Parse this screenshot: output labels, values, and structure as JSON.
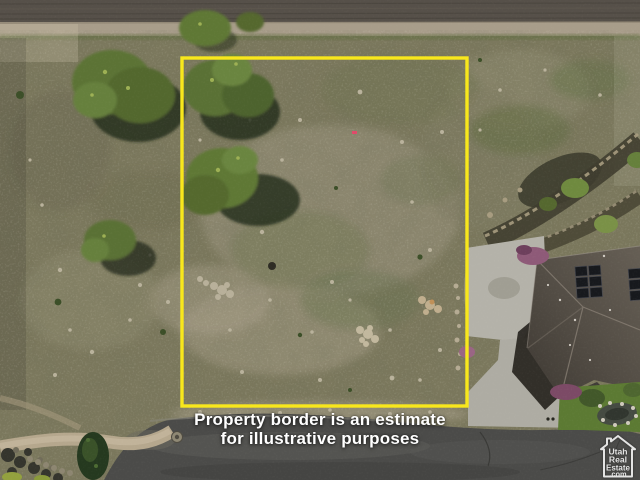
{
  "scene": {
    "name": "aerial-lot-photo",
    "colors": {
      "border_yellow": "#f8e71c",
      "scrub_ground": "#7b785d",
      "stony_patch": "#a39c87",
      "tree_canopy": "#5e7637",
      "dirt_field": "#565049",
      "gravel_road": "#a89d8a",
      "asphalt_road": "#4b4b49",
      "concrete": "#b4b2a9",
      "house_roof": "#56504a",
      "solar_panel": "#17191d",
      "lawn": "#5c7a33"
    }
  },
  "caption": {
    "line1": "Property border is an estimate",
    "line2": "for illustrative purposes"
  },
  "watermark": {
    "line1": "Utah",
    "line2": "Real",
    "line3": "Estate",
    "line4": ".com"
  }
}
